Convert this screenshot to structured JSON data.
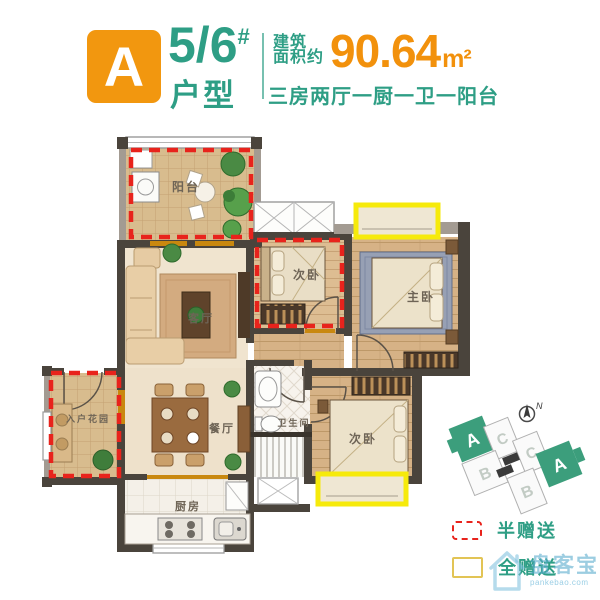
{
  "header": {
    "unit_letter": "A",
    "building_number": "5/6",
    "building_number_suffix": "#",
    "unit_type_label": "户型",
    "area_label_line1": "建筑",
    "area_label_line2": "面积约",
    "area_value": "90.64",
    "area_unit": "m²",
    "layout_summary": "三房两厅一厨一卫一阳台"
  },
  "floorplan": {
    "rooms": {
      "balcony": {
        "label": "阳台"
      },
      "living": {
        "label": "客厅"
      },
      "bedroom2": {
        "label": "次卧"
      },
      "master": {
        "label": "主卧"
      },
      "garden": {
        "label": "入户花园"
      },
      "dining": {
        "label": "餐厅"
      },
      "kitchen": {
        "label": "厨房"
      },
      "bathroom": {
        "label": "卫生间"
      },
      "bedroom3": {
        "label": "次卧"
      }
    },
    "highlights": {
      "half_gift_color": "#E8231C",
      "full_gift_color": "#F6EA0B"
    }
  },
  "sitemap": {
    "compass_label": "N",
    "highlight_color": "#3C9E7C",
    "units": [
      {
        "label": "A",
        "highlighted": true
      },
      {
        "label": "C",
        "highlighted": false
      },
      {
        "label": "C",
        "highlighted": false
      },
      {
        "label": "A",
        "highlighted": true
      },
      {
        "label": "B",
        "highlighted": false
      },
      {
        "label": "B",
        "highlighted": false
      }
    ]
  },
  "legend": {
    "half_gift_label": "半赠送",
    "full_gift_label": "全赠送"
  },
  "watermark": {
    "name": "盘客宝",
    "url": "pankebao.com"
  },
  "colors": {
    "accent_orange": "#F2970F",
    "accent_green": "#2E9E85"
  }
}
